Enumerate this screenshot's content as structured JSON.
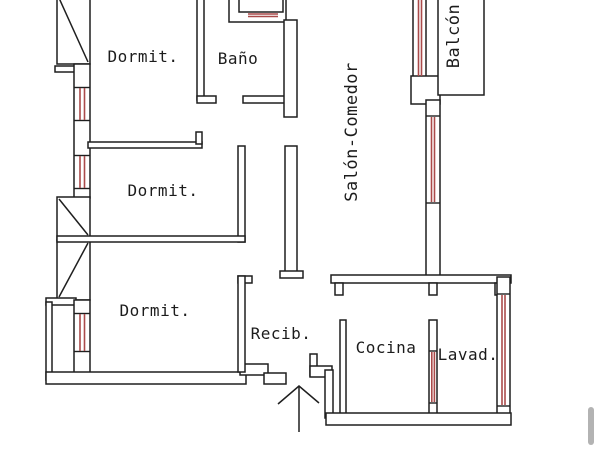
{
  "plan": {
    "title": "apartment-floor-plan",
    "rooms": {
      "dormit1": {
        "label": "Dormit."
      },
      "bano": {
        "label": "Baño"
      },
      "dormit2": {
        "label": "Dormit."
      },
      "dormit3": {
        "label": "Dormit."
      },
      "salon": {
        "label": "Salón-Comedor"
      },
      "balcon": {
        "label": "Balcón"
      },
      "recib": {
        "label": "Recib."
      },
      "cocina": {
        "label": "Cocina"
      },
      "lavad": {
        "label": "Lavad."
      }
    },
    "icons": {
      "entrance_arrow": "up-arrow",
      "closet_symbol": "crossed-box",
      "window_marker": "red-double-line"
    },
    "colors": {
      "wall": "#1f1f1f",
      "window": "#aa4a4a",
      "background": "#ffffff",
      "scrollbar": "#b3b3b3",
      "text": "#1c1c1c"
    }
  }
}
